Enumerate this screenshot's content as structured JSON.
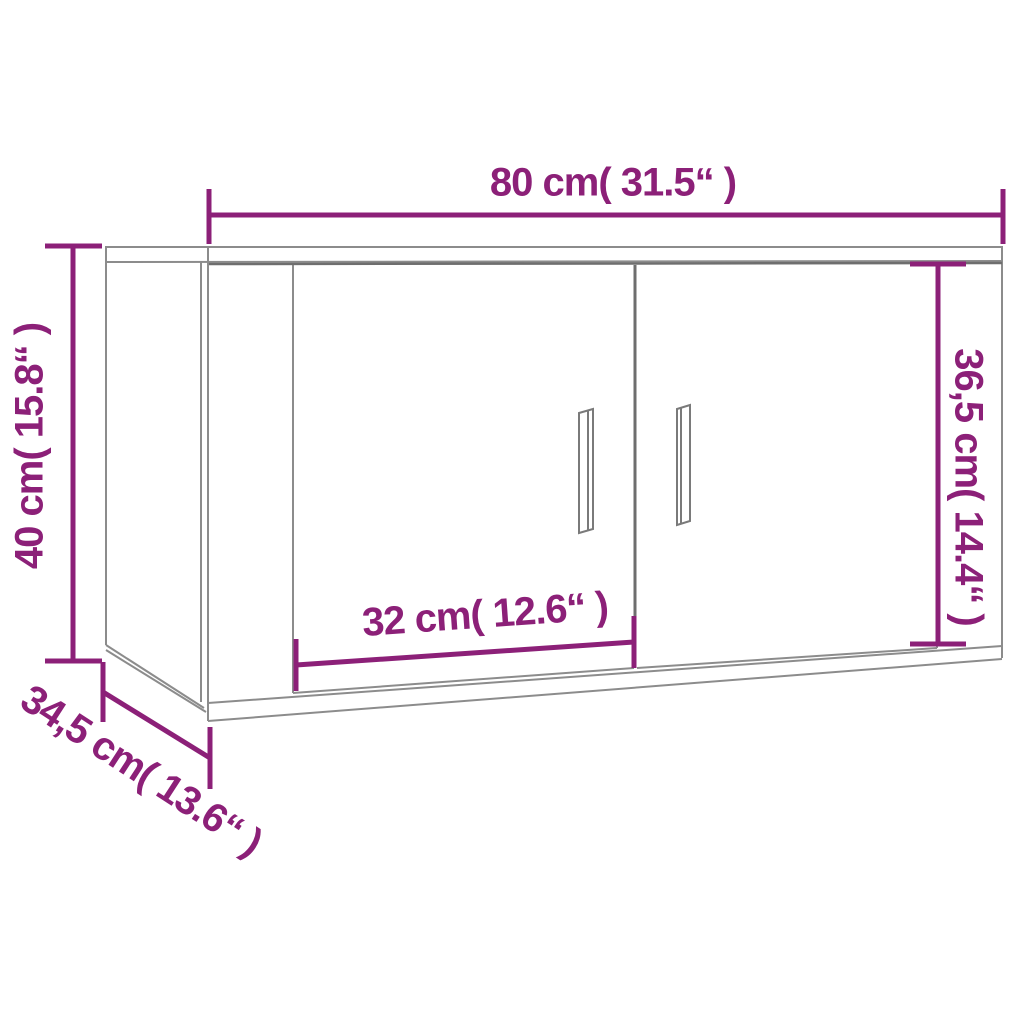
{
  "diagram": {
    "subject": "wall-mounted two-door cabinet dimension drawing",
    "dimensions": {
      "width": {
        "label": "80 cm( 31.5“ )",
        "cm": 80,
        "inch": 31.5
      },
      "height": {
        "label": "40 cm( 15.8“ )",
        "cm": 40,
        "inch": 15.8
      },
      "door_height": {
        "label": "36,5 cm( 14.4“ )",
        "cm": 36.5,
        "inch": 14.4
      },
      "door_width": {
        "label": "32 cm( 12.6“ )",
        "cm": 32,
        "inch": 12.6
      },
      "depth": {
        "label": "34,5 cm( 13.6“ )",
        "cm": 34.5,
        "inch": 13.6
      }
    },
    "colors": {
      "dimension_accent": "#8C2078",
      "outline_gray": "#8C8C8C",
      "outline_dark_gray": "#6E6E6E",
      "background": "#FFFFFF"
    }
  }
}
